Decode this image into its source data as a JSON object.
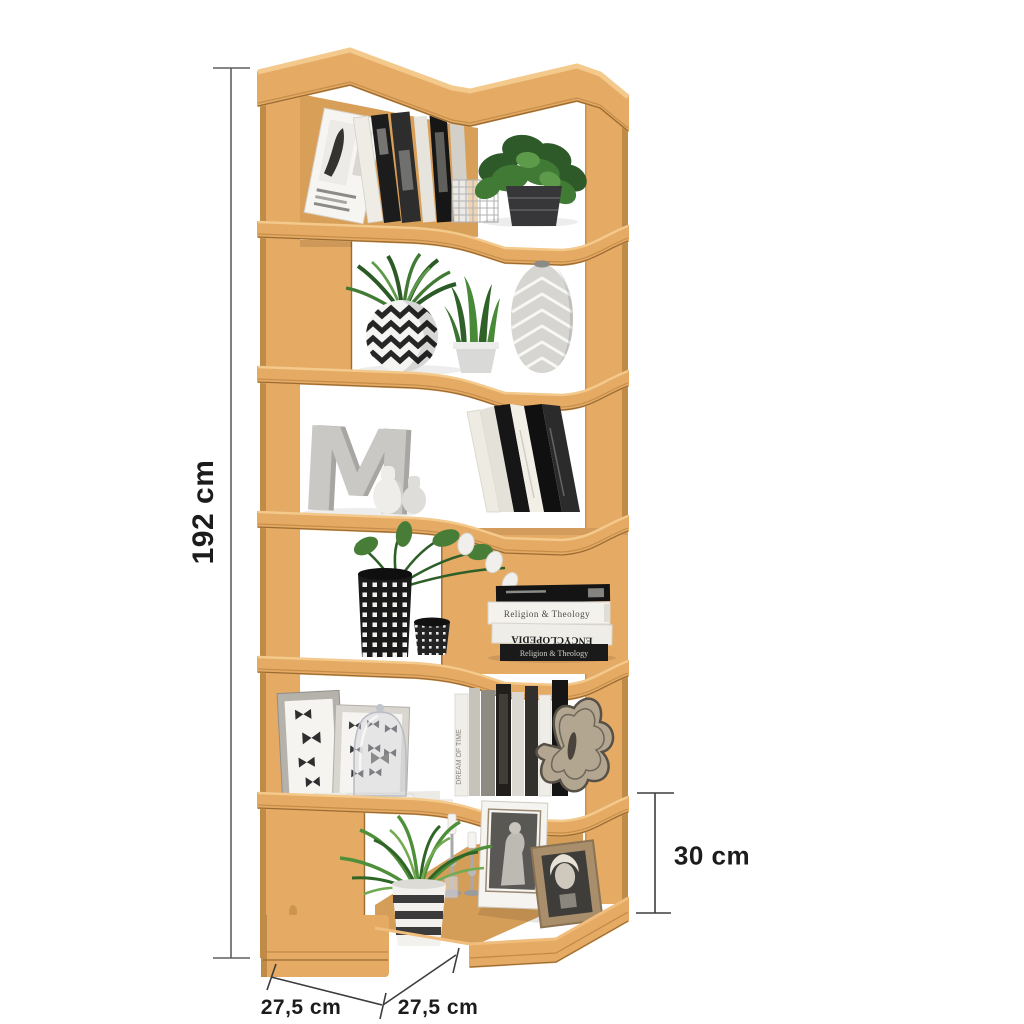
{
  "annotations": {
    "total_height": "192 cm",
    "section_height": "30 cm",
    "depth_left_wing": "27,5 cm",
    "depth_right_wing": "27,5 cm"
  },
  "decor": {
    "letter_sculpture": "M",
    "spine_religion": "Religion & Theology",
    "spine_encyclopedia": "ENCYCLOPEDIA",
    "spine_dream": "DREAM OF TIME"
  },
  "colors": {
    "background": "#ffffff",
    "wood_face": "#e5aa64",
    "wood_back": "#d89f58",
    "wood_top_highlight": "#f3c98c",
    "wood_edge_dark": "#c08a47",
    "wood_edge_line": "#9a6c33",
    "wood_floor": "#d49e58",
    "dimension_line": "#4a4a4a",
    "label_text": "#1c1c1c",
    "plant_green": "#417a35"
  },
  "shelf": {
    "type": "zigzag corner shelf, 6 compartments, beech wood",
    "tiers": [
      {
        "name": "tier-1",
        "items": [
          "leaning-magazine",
          "books-row",
          "wire-basket",
          "potted-plant"
        ]
      },
      {
        "name": "tier-2",
        "items": [
          "zigzag-pot-plant",
          "snake-plant",
          "chevron-vase"
        ]
      },
      {
        "name": "tier-3",
        "items": [
          "concrete-letter-m",
          "small-vases",
          "leaning-books"
        ]
      },
      {
        "name": "tier-4",
        "items": [
          "checkered-pot-plant",
          "small-checkered-pot",
          "horizontal-book-stack"
        ]
      },
      {
        "name": "tier-5",
        "items": [
          "butterfly-print-frames",
          "glass-cloche",
          "paper-stack",
          "book-row",
          "butterfly-cutout"
        ]
      },
      {
        "name": "tier-6",
        "items": [
          "spider-plant",
          "candlesticks",
          "photo-frames"
        ]
      }
    ]
  }
}
